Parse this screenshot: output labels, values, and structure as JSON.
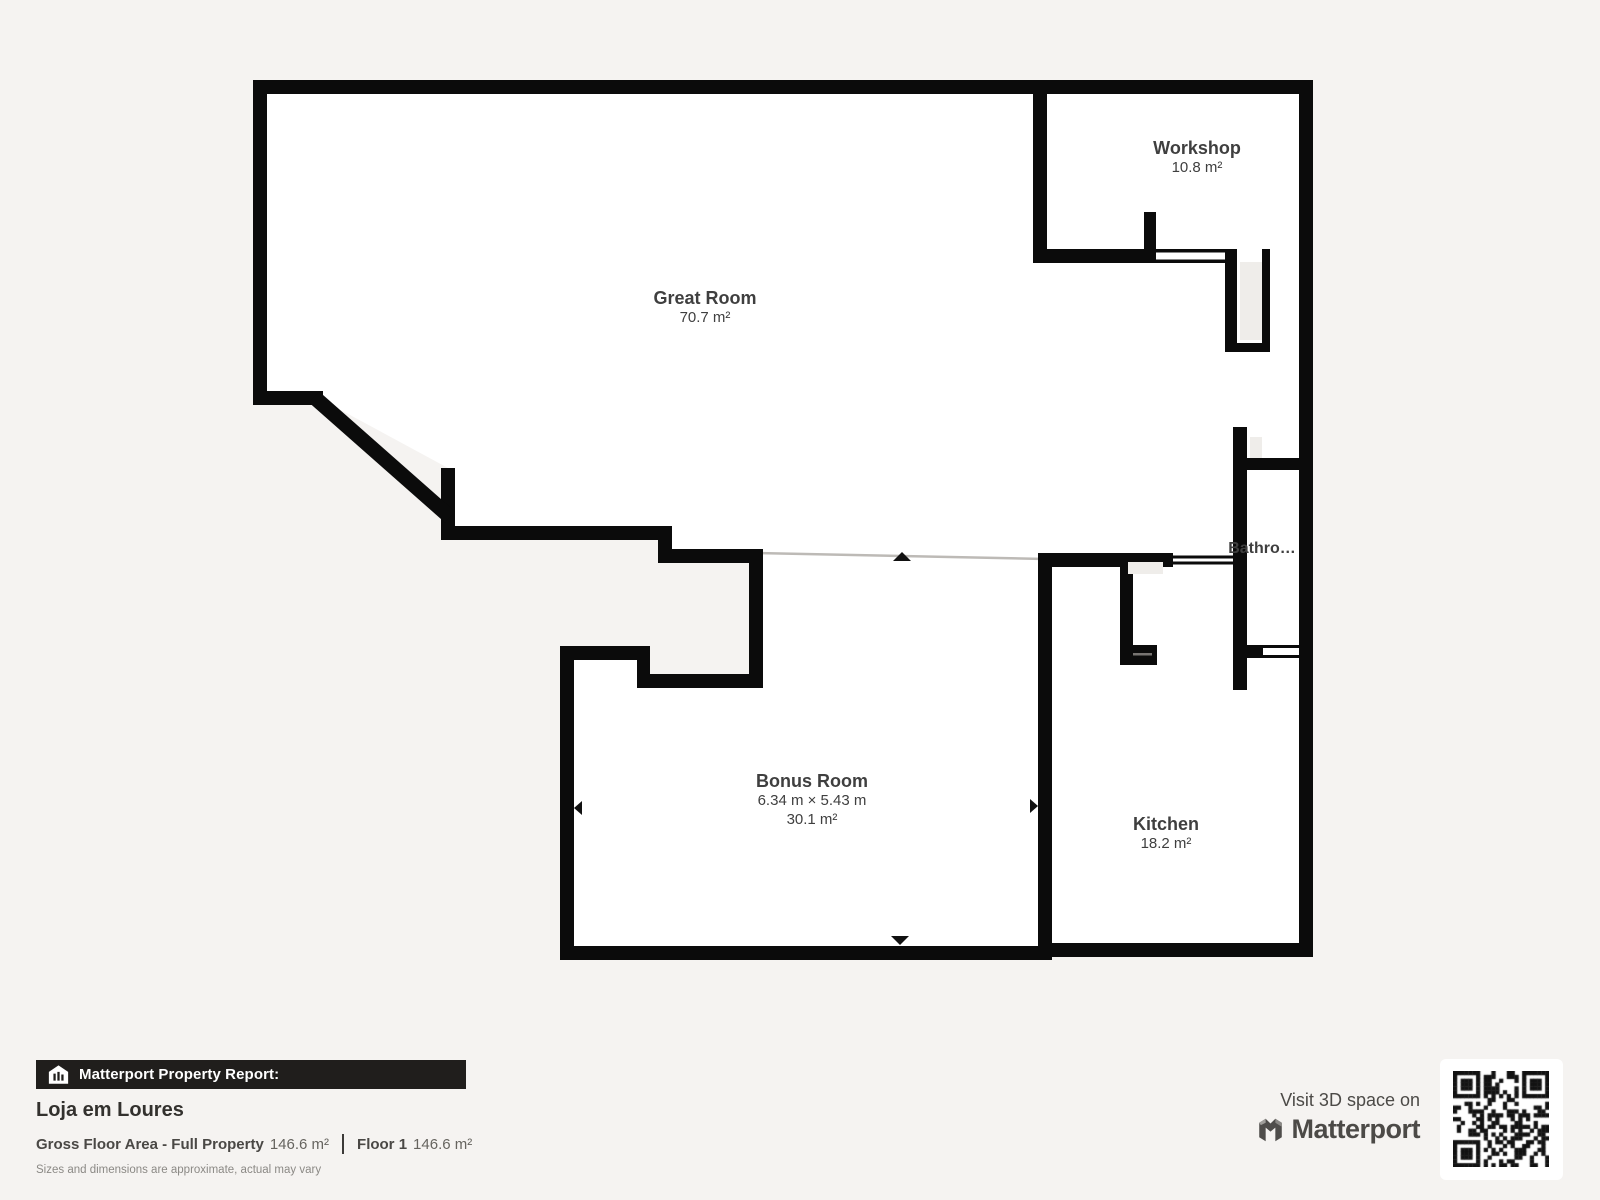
{
  "report": {
    "header_label": "Matterport Property Report:",
    "property_name": "Loja em Loures",
    "gfa_label": "Gross Floor Area - Full Property",
    "gfa_value": "146.6 m²",
    "floor_label": "Floor 1",
    "floor_value": "146.6 m²",
    "disclaimer": "Sizes and dimensions are approximate, actual may vary"
  },
  "branding": {
    "visit_text": "Visit 3D space on",
    "brand_name": "Matterport"
  },
  "floorplan": {
    "rooms": [
      {
        "name": "Great Room",
        "area": "70.7 m²"
      },
      {
        "name": "Workshop",
        "area": "10.8 m²"
      },
      {
        "name": "Bathro…",
        "area": ""
      },
      {
        "name": "Bonus Room",
        "dimensions": "6.34 m × 5.43 m",
        "area": "30.1 m²"
      },
      {
        "name": "Kitchen",
        "area": "18.2 m²"
      }
    ]
  },
  "colors": {
    "background": "#f5f3f1",
    "wall": "#0b0b0b",
    "room_fill": "#ffffff",
    "label_text": "#3f3f3f",
    "header_bar": "#201e1c",
    "open_boundary_line": "#bdbab6"
  }
}
